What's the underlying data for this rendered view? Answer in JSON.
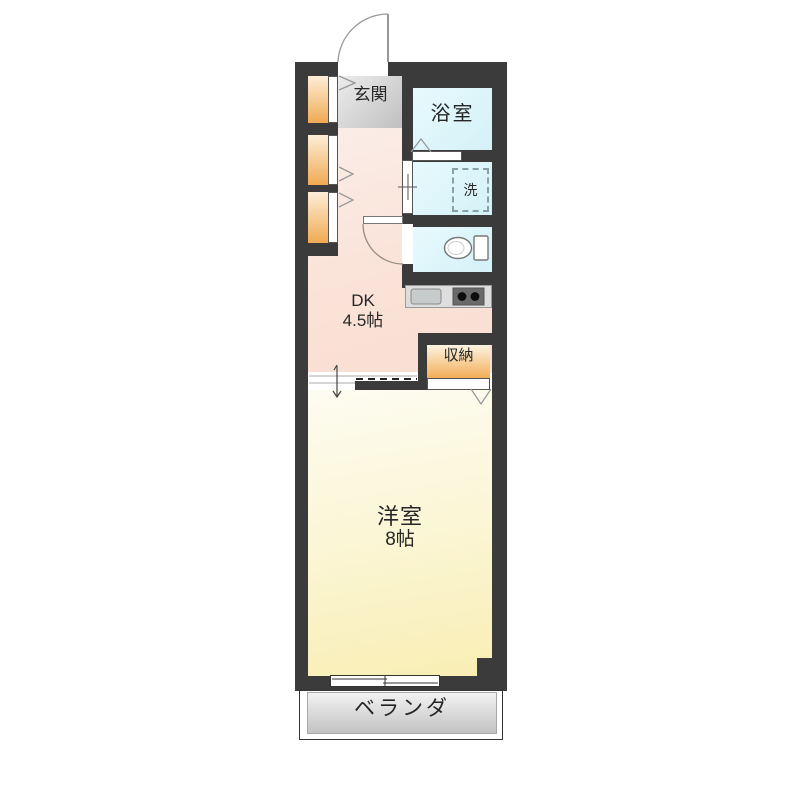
{
  "rooms": {
    "genkan": {
      "label": "玄関"
    },
    "bathroom": {
      "label": "浴室"
    },
    "laundry_space": {
      "label": "洗"
    },
    "dining_kitchen": {
      "label": "DK",
      "size": "4.5帖"
    },
    "storage": {
      "label": "収納"
    },
    "western_room": {
      "label": "洋室",
      "size": "8帖"
    },
    "veranda": {
      "label": "ベランダ"
    }
  },
  "icons": [
    "entrance-door-arc",
    "toilet-door-arc",
    "toilet-icon",
    "kitchen-sink-icon",
    "stove-icon",
    "washing-machine-area",
    "closet-chevron",
    "bathroom-door-chevron",
    "storage-door-chevron",
    "sliding-door-arrow",
    "sliding-window"
  ],
  "colors": {
    "wall": "#3b3b3b",
    "dk_floor": "#fae3d9",
    "western_room_floor": "#f8eeb4",
    "wet_area_floor": "#d4f1f7",
    "closet_floor": "#f0aa52",
    "storage_floor": "#f2ae58",
    "genkan_floor": "#c8c8c8",
    "veranda_floor": "#c3c3c3",
    "kitchen_counter": "#dedede",
    "background": "#ffffff"
  }
}
